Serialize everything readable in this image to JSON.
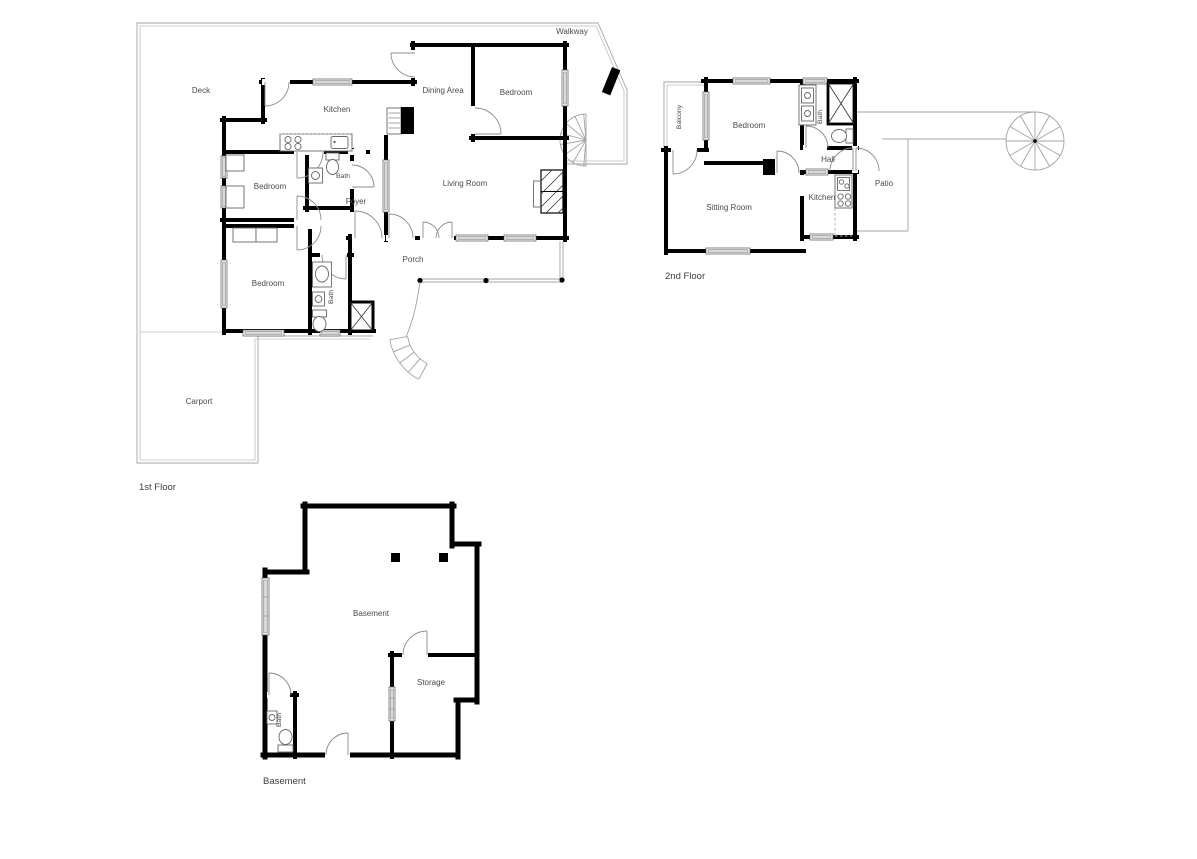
{
  "floors": {
    "first": {
      "name": "1st Floor",
      "rooms": {
        "walkway": "Walkway",
        "deck": "Deck",
        "kitchen": "Kitchen",
        "dining_area": "Dining Area",
        "bedroom_ne": "Bedroom",
        "living_room": "Living Room",
        "bedroom_w": "Bedroom",
        "bath_main": "Bath",
        "foyer": "Foyer",
        "bedroom_sw": "Bedroom",
        "bath_lower": "Bath",
        "porch": "Porch",
        "carport": "Carport"
      }
    },
    "second": {
      "name": "2nd Floor",
      "rooms": {
        "balcony": "Balcony",
        "bedroom": "Bedroom",
        "bath": "Bath",
        "hall": "Hall",
        "patio": "Patio",
        "sitting_room": "Sitting Room",
        "kitchen": "Kitchen"
      }
    },
    "basement": {
      "name": "Basement",
      "rooms": {
        "basement": "Basement",
        "storage": "Storage",
        "bath": "Bath"
      }
    }
  },
  "colors": {
    "wall": "#000000",
    "boundary_line": "#a3a3a3",
    "window_fill": "#d9d9d9",
    "label_text": "#4a4a4a",
    "background": "#ffffff"
  }
}
